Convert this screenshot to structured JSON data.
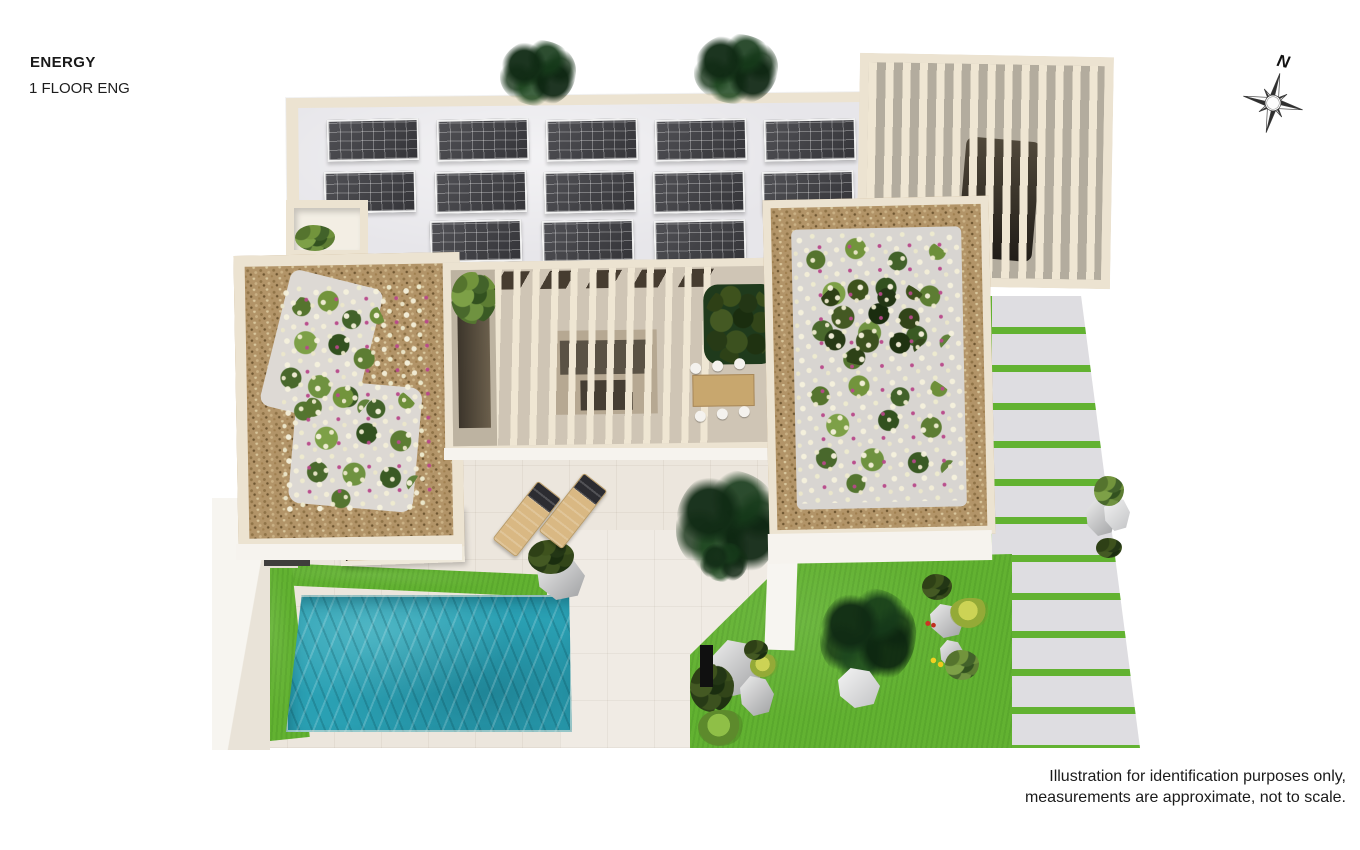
{
  "header": {
    "title": "ENERGY",
    "subtitle": "1 FLOOR ENG"
  },
  "compass": {
    "label": "N"
  },
  "footer": {
    "disclaimer_line1": "Illustration for identification purposes only,",
    "disclaimer_line2": "measurements are approximate, not to scale."
  },
  "palette": {
    "wall_cream": "#ece3d1",
    "wall_face": "#f6f3ee",
    "roof_deck": "#e7e6ea",
    "paving": "#ece6dd",
    "paving_light": "#f0ebe4",
    "solar_dark": "#3d3d42",
    "gravel": "#b29468",
    "lawn": "#62b231",
    "pool": "#2aa0b3",
    "slat": "#efe6d3",
    "driveway_slab": "#dedde1",
    "glass_amber": "#c29a63"
  },
  "scene": {
    "solar_array": {
      "rows": [
        5,
        5,
        3
      ],
      "total_panels": 13
    },
    "elements": [
      "solar-panel-array",
      "carport-pergola",
      "car",
      "green-roof-garden-left",
      "green-roof-garden-right",
      "courtyard-pergola",
      "outdoor-dining-set",
      "planter-tree",
      "swimming-pool",
      "lawn",
      "paved-terrace",
      "sun-loungers",
      "grass-joint-driveway",
      "entrance-skylight",
      "roof-lightwell",
      "trees",
      "rocks",
      "compass-rose"
    ]
  }
}
